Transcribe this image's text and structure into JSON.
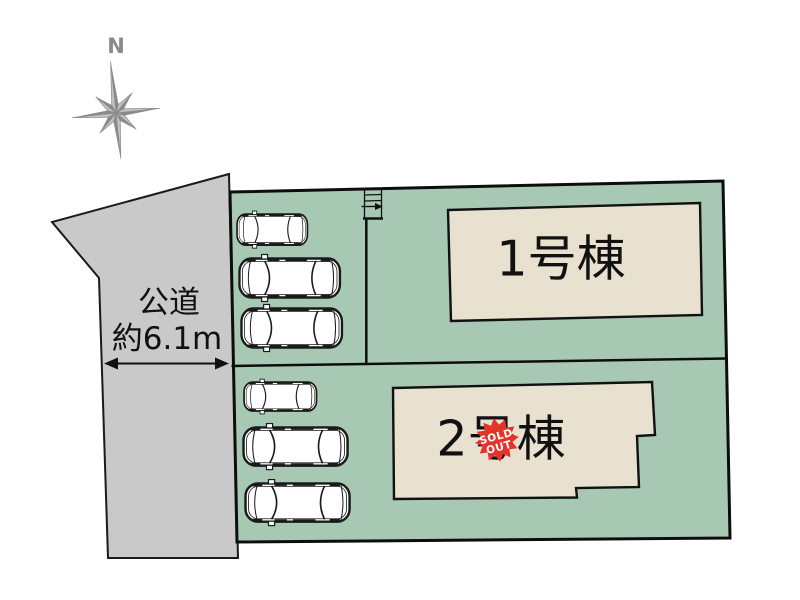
{
  "diagram_title": "分譲地区画図",
  "compass": {
    "label": "N"
  },
  "road": {
    "label_line1": "公道",
    "label_line2": "約6.1m"
  },
  "buildings": [
    {
      "id": "1",
      "label": "1号棟",
      "sold_out": false
    },
    {
      "id": "2",
      "label": "2号棟",
      "sold_out": true
    }
  ],
  "badge": {
    "line1": "SOLD",
    "line2": "OUT"
  },
  "parking": {
    "upper_car_count": 3,
    "lower_car_count": 3
  },
  "colors": {
    "site": "#a7c8b2",
    "road": "#c9c9c9",
    "building": "#e9e1d0",
    "outline": "#111111",
    "badge": "#e5332a",
    "badge_text": "#ffffff",
    "compass_dark": "#8a8a8a",
    "compass_light": "#c2c2c2"
  }
}
